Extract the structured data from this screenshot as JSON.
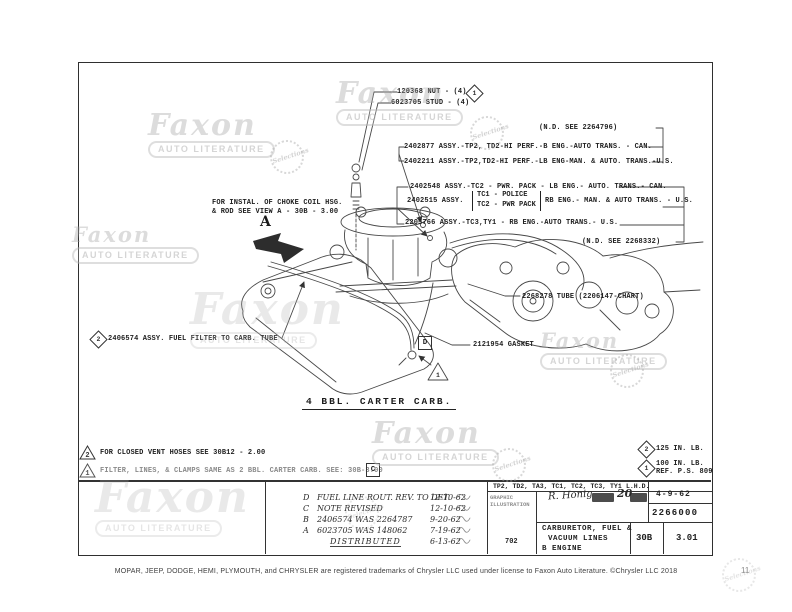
{
  "watermark": {
    "name": "Faxon",
    "subtitle": "AUTO LITERATURE",
    "seal": "Selections"
  },
  "callouts": {
    "nut_label": "120368 NUT - (4)",
    "nut_symbol": "1",
    "stud_label": "6023705 STUD - (4)",
    "nd_top": "(N.D. SEE 2264796)",
    "nd_bottom": "(N.D. SEE 2268332)",
    "assy_rows_top": [
      "2402877 ASSY.-TP2, TD2-HI PERF.-B ENG.-AUTO TRANS. - CAN.",
      "2402211 ASSY.-TP2,TD2-HI PERF.-LB ENG-MAN. & AUTO. TRANS.-U.S."
    ],
    "assy_2402548": "2402548 ASSY.-TC2 - PWR. PACK - LB ENG.- AUTO. TRANS.- CAN.",
    "assy_2402515_prefix": "2402515 ASSY.",
    "assy_2402515_opt1": "TC1 - POLICE",
    "assy_2402515_opt2": "TC2 - PWR PACK",
    "assy_2402515_suffix": "RB ENG.- MAN. & AUTO TRANS. - U.S.",
    "assy_2205766": "2205766 ASSY.-TC3,TY1 - RB ENG.-AUTO TRANS.- U.S.",
    "choke_line1": "FOR INSTAL. OF CHOKE COIL HSG.",
    "choke_line2": "& ROD SEE VIEW A - 30B - 3.00",
    "view_letter": "A",
    "tube_label": "2268278 TUBE (2206147-CHART)",
    "gasket_label": "2121954 GASKET",
    "filter_symbol": "2",
    "filter_label": "2406574 ASSY. FUEL FILTER TO CARB. TUBE",
    "detail_d": "D",
    "detail_triangle": "1",
    "caption": "4 BBL. CARTER CARB."
  },
  "notes": {
    "vent_symbol": "2",
    "vent_note": "FOR CLOSED VENT HOSES SEE 30B12 - 2.00",
    "filter_note_symbol": "1",
    "filter_note": "FILTER, LINES, & CLAMPS SAME AS 2 BBL. CARTER CARB. SEE: 30B-3.00",
    "filter_note_box": "C",
    "torque_125_symbol": "2",
    "torque_125": "125 IN. LB.",
    "torque_100_symbol": "1",
    "torque_100_line1": "100 IN. LB.",
    "torque_100_line2": "REF. P.S. 809"
  },
  "title_block": {
    "revisions": [
      {
        "letter": "D",
        "description": "FUEL LINE ROUT. REV. TO DET.",
        "date": "12-10-62"
      },
      {
        "letter": "C",
        "description": "NOTE REVISED",
        "date": "12-10-62"
      },
      {
        "letter": "B",
        "description": "2406574 WAS 2264787",
        "date": "9-20-62"
      },
      {
        "letter": "A",
        "description": "6023705 WAS 148062",
        "date": "7-19-62"
      },
      {
        "letter": "",
        "description": "DISTRIBUTED",
        "date": "6-13-62"
      }
    ],
    "models": "TP2, TD2, TA3, TC1, TC2, TC3, TY1",
    "drive": "L.H.D.",
    "dept_line1": "GRAPHIC",
    "dept_line2": "ILLUSTRATION",
    "dept_number": "702",
    "signature": "R. Honig",
    "approval_mark": "20",
    "date": "4-9-62",
    "drawing_number": "2266000",
    "title_line1": "CARBURETOR, FUEL &",
    "title_line2": "VACUUM LINES",
    "title_line3": "B ENGINE",
    "sheet": "30B",
    "revision_no": "3.01"
  },
  "footer": {
    "trademark": "MOPAR, JEEP, DODGE, HEMI, PLYMOUTH, and CHRYSLER are registered trademarks of Chrysler LLC used under license to Faxon Auto Literature. ©Chrysler LLC 2018",
    "page_number": "11"
  }
}
